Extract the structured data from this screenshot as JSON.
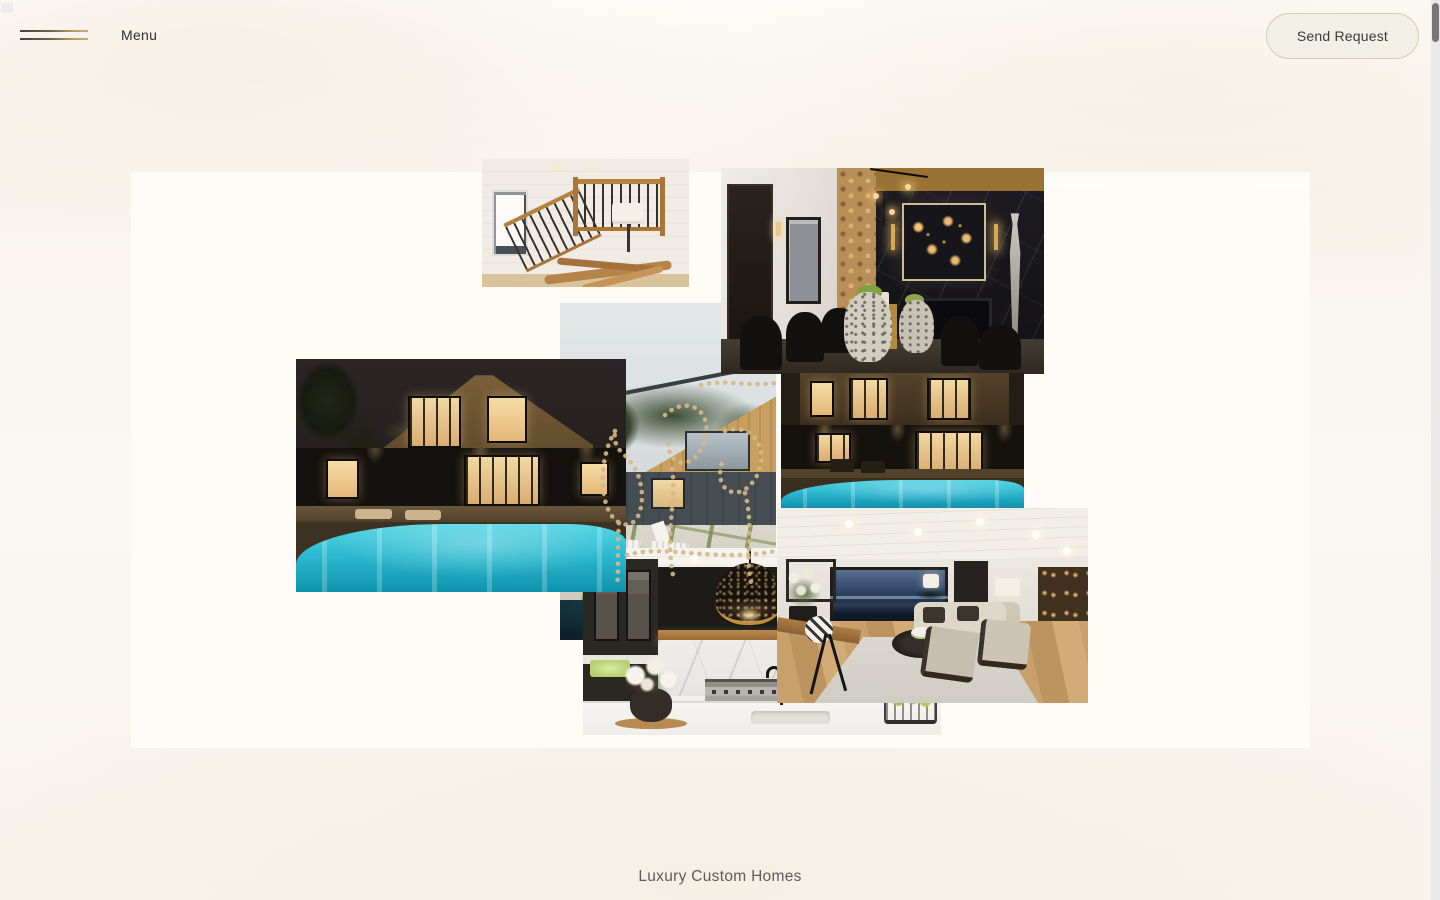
{
  "header": {
    "menu": {
      "label": "Menu"
    },
    "cta": {
      "label": "Send Request"
    }
  },
  "footer": {
    "tagline": "Luxury Custom Homes"
  },
  "theme": {
    "background_top": "#fefdfb",
    "background_cream": "#f8f4ec",
    "collage_panel": "#fffdf8",
    "accent_tan": "#c7ab79",
    "button_bg": "#f2efe7",
    "button_border": "#d9cbb1",
    "text_dark": "#2f2e2b",
    "text_muted": "#5d5c59",
    "scrollbar_thumb": "#767676",
    "scrollbar_track": "#e8e8e7",
    "ornament_dots": "#d6b888",
    "pool_turquoise": "#2cb9cf"
  },
  "gallery": {
    "photos": [
      {
        "id": "staircase",
        "label": "Staircase with wood railing and driftwood console"
      },
      {
        "id": "dining-room",
        "label": "Dark marble dining room with firewood wall and sculpture"
      },
      {
        "id": "pool-house-night-wide",
        "label": "Modern home with glowing pool at night, wide view"
      },
      {
        "id": "backyard-day",
        "label": "Daytime backyard patio with white loungers"
      },
      {
        "id": "pool-house-night-close",
        "label": "Modern home with glowing pool at night, close view"
      },
      {
        "id": "living-room",
        "label": "Living room with dusk ocean view"
      },
      {
        "id": "kitchen",
        "label": "Kitchen with black perforated pendant light"
      }
    ]
  },
  "icons": {
    "menu_icon": "hamburger-lines-icon"
  }
}
